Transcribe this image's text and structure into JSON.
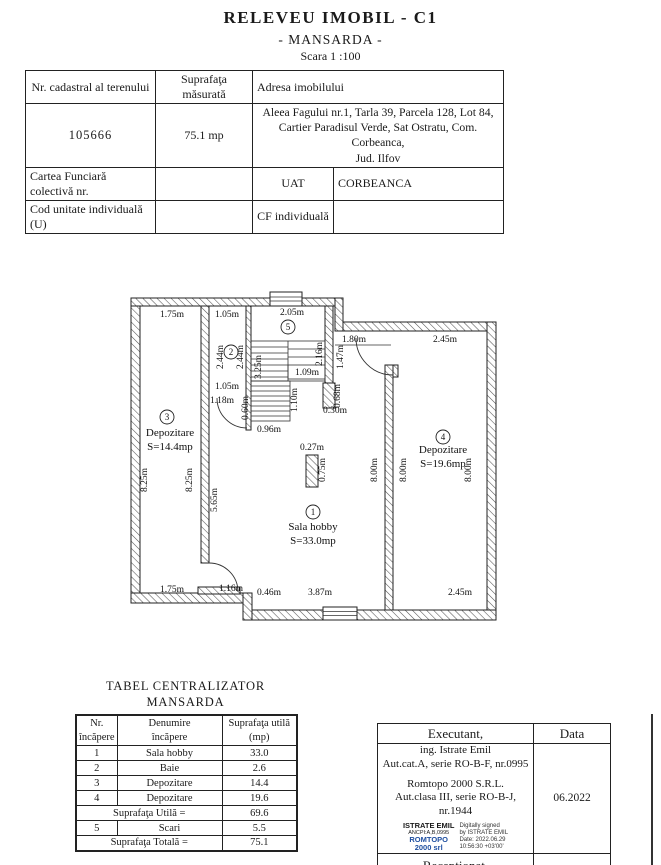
{
  "title": {
    "main": "RELEVEU  IMOBIL - C1",
    "subtitle": "- MANSARDA -",
    "scale": "Scara 1 :100"
  },
  "info_table": {
    "cadastral_header": "Nr. cadastral al terenului",
    "area_header": "Suprafaţa măsurată",
    "address_header": "Adresa  imobilului",
    "cadastral_number": "105666",
    "measured_area": "75.1 mp",
    "address_line1": "Aleea Fagului nr.1, Tarla 39, Parcela 128, Lot 84,",
    "address_line2": "Cartier Paradisul Verde, Sat Ostratu, Com. Corbeanca,",
    "address_line3": "Jud. Ilfov",
    "land_book_label": "Cartea Funciară colectivă nr.",
    "uat_label": "UAT",
    "uat_value": "CORBEANCA",
    "unit_code_label": "Cod unitate individuală (U)",
    "cf_label": "CF individuală",
    "cf_value": ""
  },
  "floor_plan": {
    "rooms": [
      {
        "number": "1",
        "name": "Sala hobby",
        "area": "S=33.0mp"
      },
      {
        "number": "2"
      },
      {
        "number": "3",
        "name": "Depozitare",
        "area": "S=14.4mp"
      },
      {
        "number": "4",
        "name": "Depozitare",
        "area": "S=19.6mp"
      },
      {
        "number": "5"
      }
    ],
    "dim_labels": [
      {
        "t": "1.75m"
      },
      {
        "t": "1.05m"
      },
      {
        "t": "2.05m"
      },
      {
        "t": "1.80m"
      },
      {
        "t": "2.45m"
      },
      {
        "t": "1.05m"
      },
      {
        "t": "1.18m"
      },
      {
        "t": "0.96m"
      },
      {
        "t": "0.30m"
      },
      {
        "t": "0.27m"
      },
      {
        "t": "1.09m"
      },
      {
        "t": "1.75m"
      },
      {
        "t": "1.16m"
      },
      {
        "t": "0.46m"
      },
      {
        "t": "3.87m"
      },
      {
        "t": "2.45m"
      },
      {
        "t": "2.44m"
      },
      {
        "t": "2.44m"
      },
      {
        "t": "3.25m"
      },
      {
        "t": "2.16m"
      },
      {
        "t": "1.47m"
      },
      {
        "t": "1.10m"
      },
      {
        "t": "0.60m"
      },
      {
        "t": "0.68m"
      },
      {
        "t": "8.25m"
      },
      {
        "t": "8.25m"
      },
      {
        "t": "5.65m"
      },
      {
        "t": "0.75m"
      },
      {
        "t": "8.00m"
      },
      {
        "t": "8.00m"
      },
      {
        "t": "8.00m"
      }
    ]
  },
  "summary": {
    "title_line1": "TABEL CENTRALIZATOR",
    "title_line2": "MANSARDA",
    "headers": {
      "col1_l1": "Nr.",
      "col1_l2": "încăpere",
      "col2_l1": "Denumire",
      "col2_l2": "încăpere",
      "col3_l1": "Suprafaţa utilă",
      "col3_l2": "(mp)"
    },
    "rows": [
      [
        "1",
        "Sala hobby",
        "33.0"
      ],
      [
        "2",
        "Baie",
        "2.6"
      ],
      [
        "3",
        "Depozitare",
        "14.4"
      ],
      [
        "4",
        "Depozitare",
        "19.6"
      ]
    ],
    "useful_label": "Suprafaţa Utilă  =",
    "useful_value": "69.6",
    "stairs_row": [
      "5",
      "Scari",
      "5.5"
    ],
    "total_label": "Suprafaţa Totală =",
    "total_value": "75.1"
  },
  "signature": {
    "executant_label": "Executant,",
    "data_label": "Data",
    "line1": "ing. Istrate Emil",
    "line2": "Aut.cat.A, serie RO-B-F, nr.0995",
    "line3": "Romtopo 2000 S.R.L.",
    "line4": "Aut.clasa III, serie RO-B-J, nr.1944",
    "stamp_name": "ISTRATE EMIL",
    "stamp_id": "ANCPI:A,B,0995",
    "stamp_org1": "ROMTOPO",
    "stamp_org2": "2000 srl",
    "stamp_blue": "#1f4fa0",
    "digital_line1": "Digitally signed",
    "digital_line2": "by ISTRATE EMIL",
    "digital_line3": "Date: 2022.06.29",
    "digital_line4": "10:56:30 +03'00'",
    "date_value": "06.2022",
    "received_label": "Recepţionat,"
  }
}
